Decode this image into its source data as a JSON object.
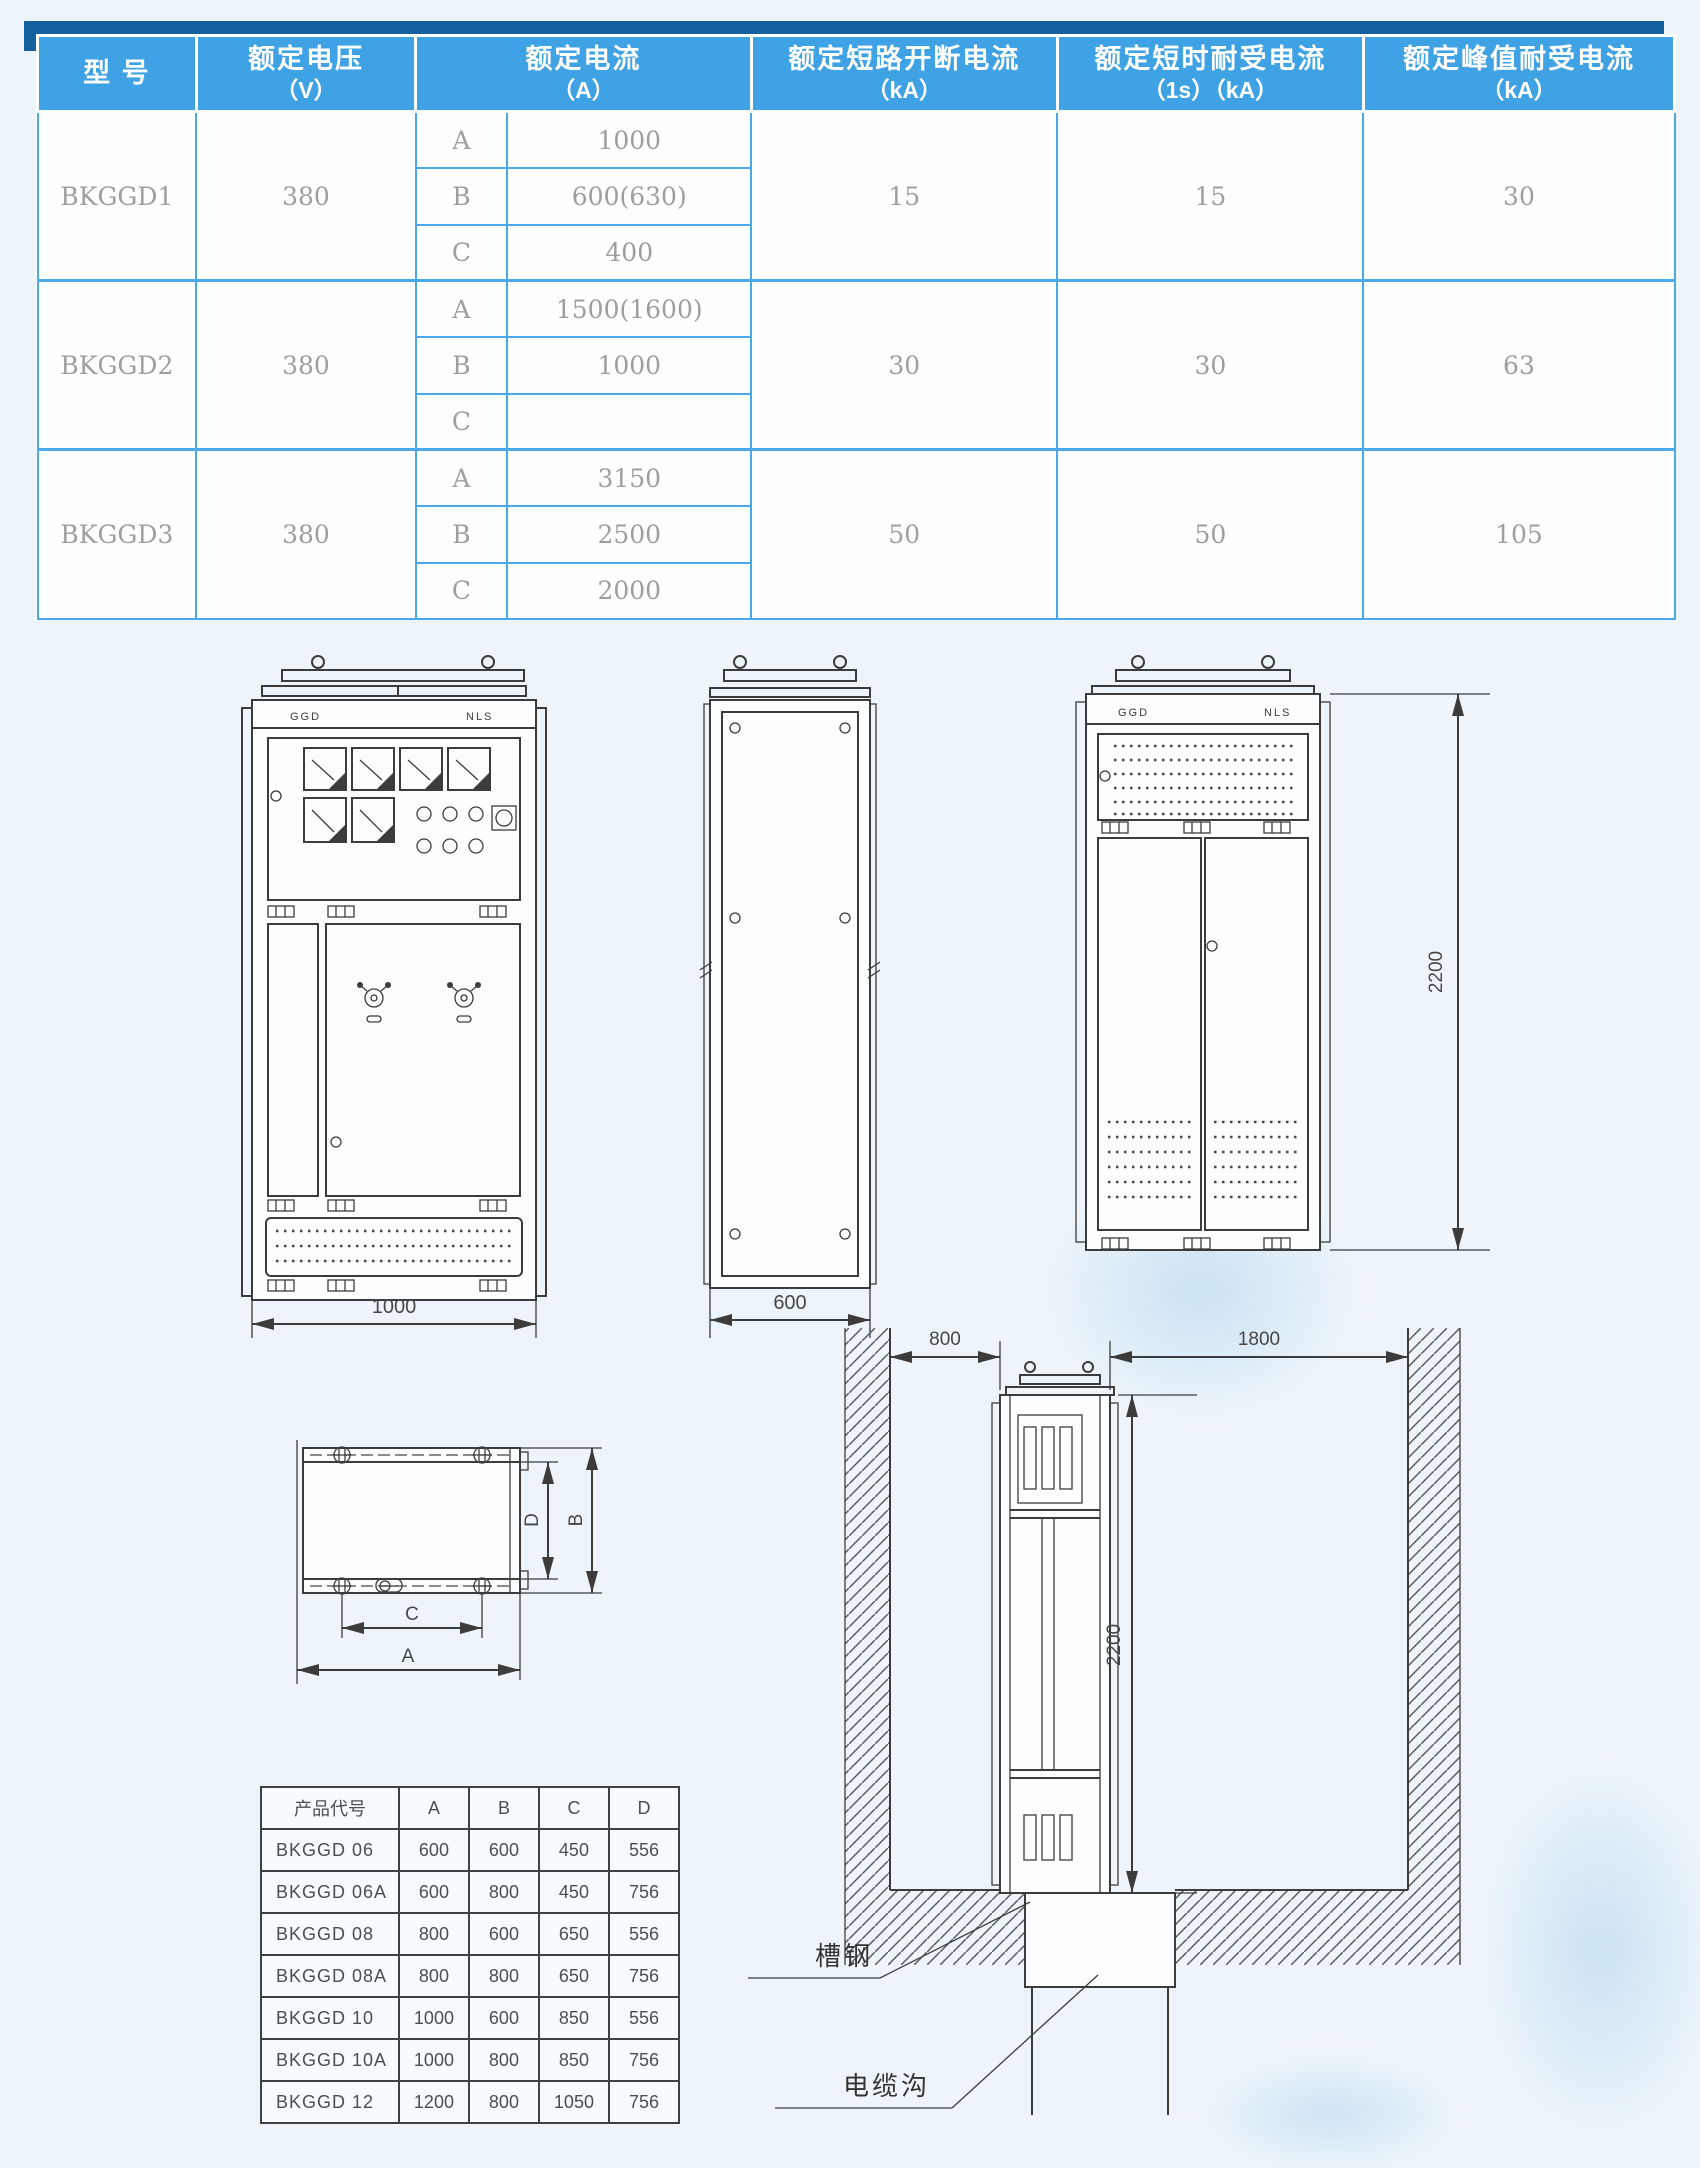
{
  "spec_table": {
    "headers": {
      "model": "型 号",
      "voltage": "额定电压",
      "voltage_unit": "（V）",
      "current": "额定电流",
      "current_unit": "（A）",
      "breaking": "额定短路开断电流",
      "breaking_unit": "（kA）",
      "short_time": "额定短时耐受电流",
      "short_time_unit": "（1s）（kA）",
      "peak": "额定峰值耐受电流",
      "peak_unit": "（kA）"
    },
    "rows": [
      {
        "model": "BKGGD1",
        "voltage": "380",
        "variants": [
          {
            "code": "A",
            "current": "1000"
          },
          {
            "code": "B",
            "current": "600(630)"
          },
          {
            "code": "C",
            "current": "400"
          }
        ],
        "breaking": "15",
        "short_time": "15",
        "peak": "30"
      },
      {
        "model": "BKGGD2",
        "voltage": "380",
        "variants": [
          {
            "code": "A",
            "current": "1500(1600)"
          },
          {
            "code": "B",
            "current": "1000"
          },
          {
            "code": "C",
            "current": ""
          }
        ],
        "breaking": "30",
        "short_time": "30",
        "peak": "63"
      },
      {
        "model": "BKGGD3",
        "voltage": "380",
        "variants": [
          {
            "code": "A",
            "current": "3150"
          },
          {
            "code": "B",
            "current": "2500"
          },
          {
            "code": "C",
            "current": "2000"
          }
        ],
        "breaking": "50",
        "short_time": "50",
        "peak": "105"
      }
    ]
  },
  "drawings": {
    "front_view": {
      "panel_label_left": "GGD",
      "panel_label_right": "NLS",
      "width_dim": "1000"
    },
    "side_view": {
      "width_dim": "600"
    },
    "back_view": {
      "panel_label_left": "GGD",
      "panel_label_right": "NLS",
      "height_dim": "2200"
    },
    "plan_view": {
      "dim_a": "A",
      "dim_b": "B",
      "dim_c": "C",
      "dim_d": "D"
    },
    "installation": {
      "left_clearance_dim": "800",
      "right_clearance_dim": "1800",
      "height_dim": "2200",
      "channel_steel_label": "槽钢",
      "cable_trench_label": "电缆沟"
    }
  },
  "dimension_table": {
    "headers": [
      "产品代号",
      "A",
      "B",
      "C",
      "D"
    ],
    "rows": [
      [
        "BKGGD 06",
        "600",
        "600",
        "450",
        "556"
      ],
      [
        "BKGGD 06A",
        "600",
        "800",
        "450",
        "756"
      ],
      [
        "BKGGD 08",
        "800",
        "600",
        "650",
        "556"
      ],
      [
        "BKGGD 08A",
        "800",
        "800",
        "650",
        "756"
      ],
      [
        "BKGGD 10",
        "1000",
        "600",
        "850",
        "556"
      ],
      [
        "BKGGD 10A",
        "1000",
        "800",
        "850",
        "756"
      ],
      [
        "BKGGD 12",
        "1200",
        "800",
        "1050",
        "756"
      ]
    ]
  },
  "colors": {
    "header_blue": "#3fa2e4",
    "header_shadow_blue": "#15619f",
    "table_border_blue": "#4ba9e9",
    "body_text_gray": "#9c9ea0"
  }
}
